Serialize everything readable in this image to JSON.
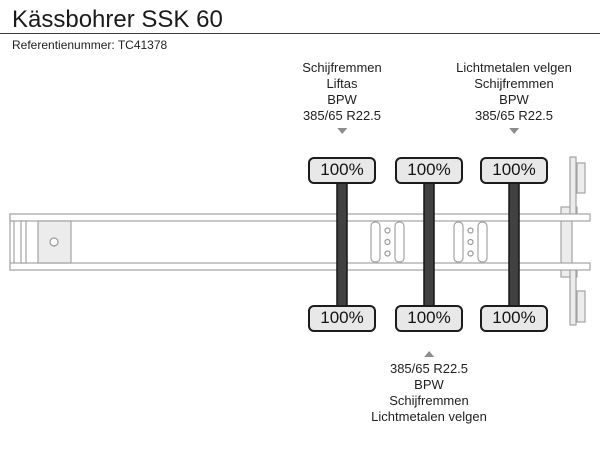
{
  "header": {
    "title": "Kässbohrer SSK 60",
    "reference": "Referentienummer: TC41378"
  },
  "specs": {
    "axle1": {
      "lines": [
        "Schijfremmen",
        "Liftas",
        "BPW",
        "385/65 R22.5"
      ]
    },
    "axle3": {
      "lines": [
        "Lichtmetalen velgen",
        "Schijfremmen",
        "BPW",
        "385/65 R22.5"
      ]
    },
    "axle2": {
      "lines": [
        "385/65 R22.5",
        "BPW",
        "Schijfremmen",
        "Lichtmetalen velgen"
      ]
    }
  },
  "axles": [
    {
      "top": "100%",
      "bottom": "100%"
    },
    {
      "top": "100%",
      "bottom": "100%"
    },
    {
      "top": "100%",
      "bottom": "100%"
    }
  ],
  "colors": {
    "tire": "#414141",
    "frame-stroke": "#a3a3a3",
    "panel-fill": "#ececec",
    "badge-fill": "#e8e8e8",
    "badge-border": "#1c1c1c",
    "arrow": "#8c8c8c",
    "text": "#1f1f1f"
  }
}
